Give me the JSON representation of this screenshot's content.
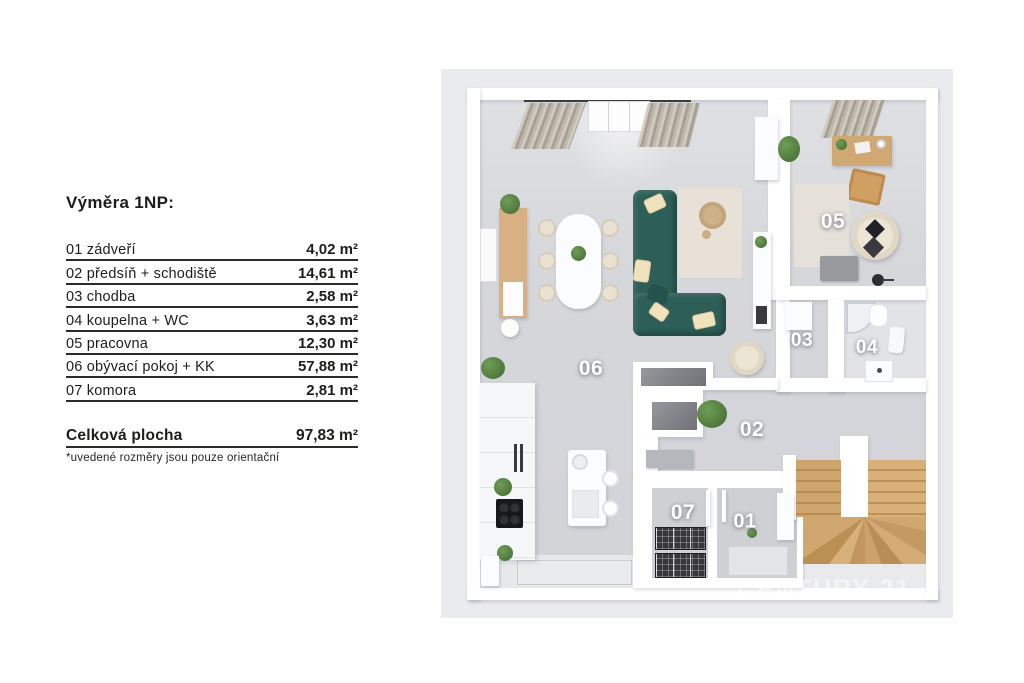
{
  "legend": {
    "heading": "Výměra 1NP:",
    "rows": [
      {
        "name": "01 zádveří",
        "area": "4,02 m²"
      },
      {
        "name": "02 předsíň + schodiště",
        "area": "14,61 m²"
      },
      {
        "name": "03 chodba",
        "area": "2,58 m²"
      },
      {
        "name": "04 koupelna + WC",
        "area": "3,63 m²"
      },
      {
        "name": "05 pracovna",
        "area": "12,30 m²"
      },
      {
        "name": "06 obývací pokoj + KK",
        "area": "57,88 m²"
      },
      {
        "name": "07 komora",
        "area": "2,81 m²"
      }
    ],
    "total": {
      "label": "Celková plocha",
      "area": "97,83 m²"
    },
    "note": "*uvedené rozměry jsou pouze orientační"
  },
  "plan": {
    "labels": {
      "r01": "01",
      "r02": "02",
      "r03": "03",
      "r04": "04",
      "r05": "05",
      "r06": "06",
      "r07": "07"
    },
    "watermark": "CENTURY 21",
    "colors": {
      "background": "#eaebef",
      "wall": "#ffffff",
      "floor": "#d5d6da",
      "sofa": "#2d5f58",
      "wood": "#c99f69",
      "curtain": "#b9b0a4",
      "plant": "#41692f"
    }
  }
}
